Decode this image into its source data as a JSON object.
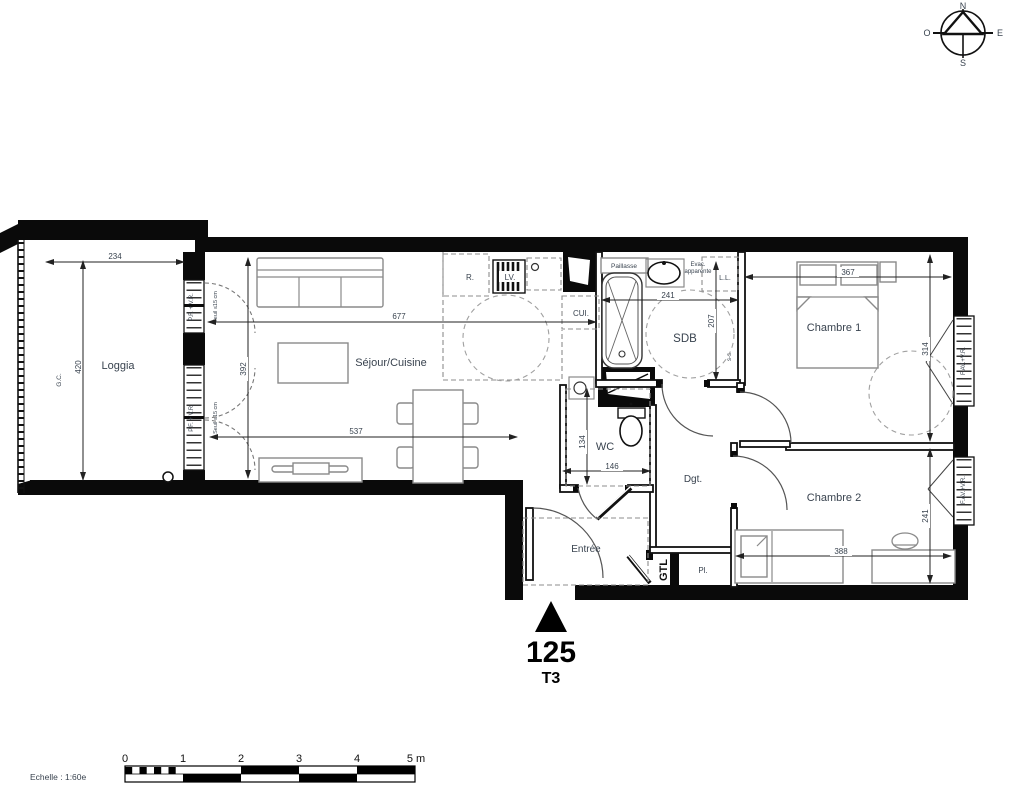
{
  "plan": {
    "unit_number": "125",
    "unit_type": "T3"
  },
  "compass": {
    "n": "N",
    "e": "E",
    "s": "S",
    "o": "O"
  },
  "scalebar": {
    "caption": "Echelle : 1:60e",
    "t0": "0",
    "t1": "1",
    "t2": "2",
    "t3": "3",
    "t4": "4",
    "t5": "5 m"
  },
  "rooms": {
    "loggia": "Loggia",
    "sejour": "Séjour/Cuisine",
    "wc": "WC",
    "sdb": "SDB",
    "dgt": "Dgt.",
    "entree": "Entrée",
    "chambre1": "Chambre 1",
    "chambre2": "Chambre 2",
    "placard": "Pl.",
    "gtl": "GTL"
  },
  "fixtures": {
    "fridge": "R.",
    "dishwasher": "LV.",
    "kitchen_counter": "CUI.",
    "worktop": "Paillasse",
    "evac_line1": "Evac.",
    "evac_line2": "apparente",
    "washing_machine": "L.L.",
    "towel_rail": "s-s",
    "gc": "G.C."
  },
  "openings": {
    "loggia_window": "P.F. + V.R.",
    "loggia_sill": "Seuil ≤15 cm",
    "room_window": "F.AV.+V.R."
  },
  "dims": {
    "loggia_w": "234",
    "loggia_h": "420",
    "sejour_h": "392",
    "sejour_w": "677",
    "sejour_w2": "537",
    "sdb_w": "241",
    "sdb_h": "207",
    "wc_h": "134",
    "wc_w": "146",
    "ch1_w": "367",
    "ch1_h": "314",
    "ch2_w": "388",
    "ch2_h": "241"
  }
}
